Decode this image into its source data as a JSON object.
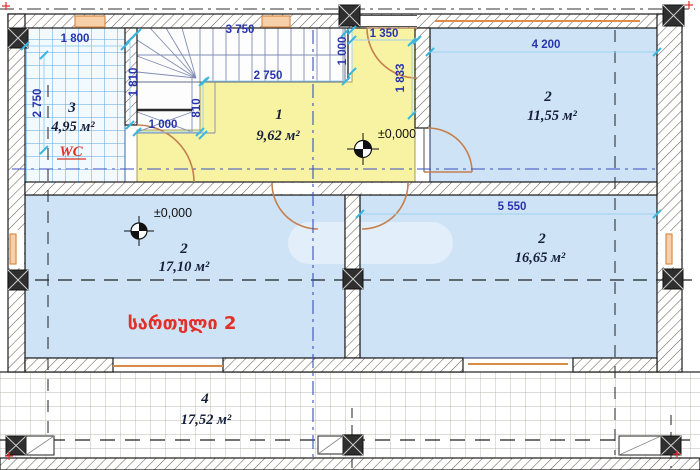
{
  "title": "floor-plan-level-2",
  "floor_label": "სართული 2",
  "level_mark": "±0,000",
  "rooms": {
    "wc": {
      "number": "3",
      "area": "4,95 м²",
      "name": "WC"
    },
    "hall": {
      "number": "1",
      "area": "9,62 м²"
    },
    "top_right": {
      "number": "2",
      "area": "11,55 м²"
    },
    "mid_left": {
      "number": "2",
      "area": "17,10 м²"
    },
    "mid_right": {
      "number": "2",
      "area": "16,65 м²"
    },
    "terrace": {
      "number": "4",
      "area": "17,52 м²"
    }
  },
  "dims": {
    "wc_width": "1 800",
    "wc_depth": "2 750",
    "stair_run": "3 750",
    "hall_width": "2 750",
    "stair_depth": "1 810",
    "stair_tread": "810",
    "stair_bottom": "1 000",
    "entry_side": "1 000",
    "entry_width": "1 350",
    "entry_depth": "1 833",
    "room_tr_width": "4 200",
    "room_mr_width": "5 550"
  },
  "colors": {
    "room_fill": "#cfe3f6",
    "hall_fill": "#f7f3a3",
    "tile_line": "#55a8dc",
    "dim_text": "#2834ad",
    "tick": "#3ab7e0",
    "door": "#c4804e",
    "window": "#e08c4a",
    "red_label": "#e03028",
    "wall": "#1a1a1a"
  }
}
